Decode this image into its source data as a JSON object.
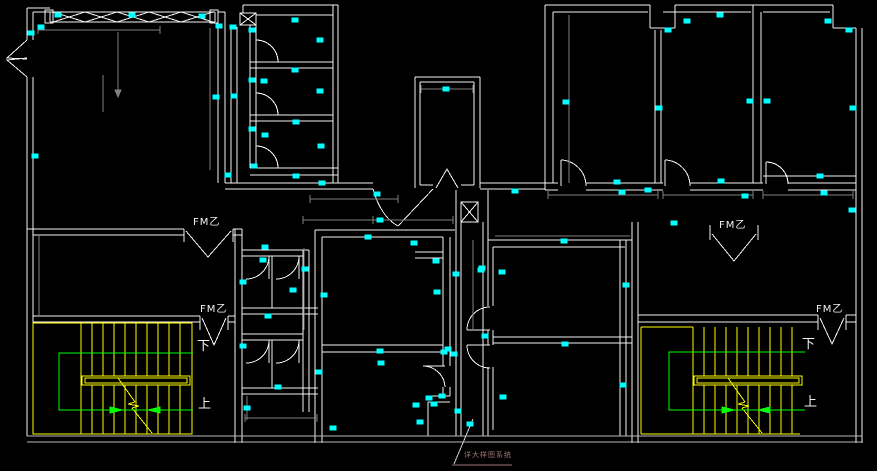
{
  "canvas": {
    "background": "#000000"
  },
  "colors": {
    "wall": "#f2f2f2",
    "outer_wall": "#b9b9b9",
    "dimension": "#808080",
    "grip": "#00ffff",
    "stair": "#ffff00",
    "walk_path": "#00ff00",
    "door_label": "#f2f2f2",
    "annotation": "#a07878"
  },
  "labels": {
    "fire_doors": [
      {
        "text": "FM乙",
        "x": 193,
        "y": 218
      },
      {
        "text": "FM乙",
        "x": 200,
        "y": 305
      },
      {
        "text": "FM乙",
        "x": 719,
        "y": 221
      },
      {
        "text": "FM乙",
        "x": 816,
        "y": 305
      }
    ],
    "stair_directions": [
      {
        "text": "下",
        "x": 197,
        "y": 340
      },
      {
        "text": "上",
        "x": 198,
        "y": 398
      },
      {
        "text": "下",
        "x": 802,
        "y": 338
      },
      {
        "text": "上",
        "x": 804,
        "y": 396
      }
    ],
    "annotation": {
      "text": "详大样图系统",
      "x": 464,
      "y": 452
    }
  },
  "grips": [
    [
      31,
      33
    ],
    [
      41,
      27
    ],
    [
      58,
      15
    ],
    [
      132,
      15
    ],
    [
      202,
      16
    ],
    [
      219,
      26
    ],
    [
      233,
      27
    ],
    [
      252,
      30
    ],
    [
      295,
      20
    ],
    [
      320,
      40
    ],
    [
      35,
      156
    ],
    [
      295,
      70
    ],
    [
      252,
      80
    ],
    [
      264,
      81
    ],
    [
      216,
      97
    ],
    [
      234,
      96
    ],
    [
      320,
      91
    ],
    [
      296,
      122
    ],
    [
      252,
      129
    ],
    [
      265,
      135
    ],
    [
      321,
      146
    ],
    [
      254,
      166
    ],
    [
      228,
      175
    ],
    [
      296,
      176
    ],
    [
      322,
      183
    ],
    [
      377,
      194
    ],
    [
      446,
      89
    ],
    [
      566,
      102
    ],
    [
      515,
      191
    ],
    [
      617,
      182
    ],
    [
      622,
      192
    ],
    [
      687,
      21
    ],
    [
      668,
      30
    ],
    [
      720,
      15
    ],
    [
      828,
      21
    ],
    [
      849,
      30
    ],
    [
      659,
      108
    ],
    [
      750,
      101
    ],
    [
      767,
      101
    ],
    [
      853,
      108
    ],
    [
      820,
      176
    ],
    [
      721,
      181
    ],
    [
      824,
      193
    ],
    [
      745,
      196
    ],
    [
      648,
      190
    ],
    [
      852,
      210
    ],
    [
      674,
      223
    ],
    [
      380,
      220
    ],
    [
      368,
      237
    ],
    [
      414,
      243
    ],
    [
      436,
      261
    ],
    [
      456,
      274
    ],
    [
      481,
      270
    ],
    [
      265,
      247
    ],
    [
      263,
      260
    ],
    [
      305,
      269
    ],
    [
      243,
      282
    ],
    [
      293,
      290
    ],
    [
      324,
      295
    ],
    [
      268,
      316
    ],
    [
      243,
      346
    ],
    [
      278,
      387
    ],
    [
      247,
      408
    ],
    [
      333,
      428
    ],
    [
      437,
      292
    ],
    [
      448,
      349
    ],
    [
      442,
      396
    ],
    [
      434,
      404
    ],
    [
      420,
      422
    ],
    [
      470,
      424
    ],
    [
      564,
      241
    ],
    [
      502,
      272
    ],
    [
      482,
      268
    ],
    [
      626,
      285
    ],
    [
      485,
      336
    ],
    [
      565,
      344
    ],
    [
      503,
      397
    ],
    [
      623,
      385
    ],
    [
      380,
      351
    ],
    [
      381,
      363
    ],
    [
      319,
      372
    ],
    [
      444,
      352
    ],
    [
      454,
      354
    ],
    [
      429,
      398
    ],
    [
      416,
      405
    ],
    [
      458,
      411
    ]
  ]
}
